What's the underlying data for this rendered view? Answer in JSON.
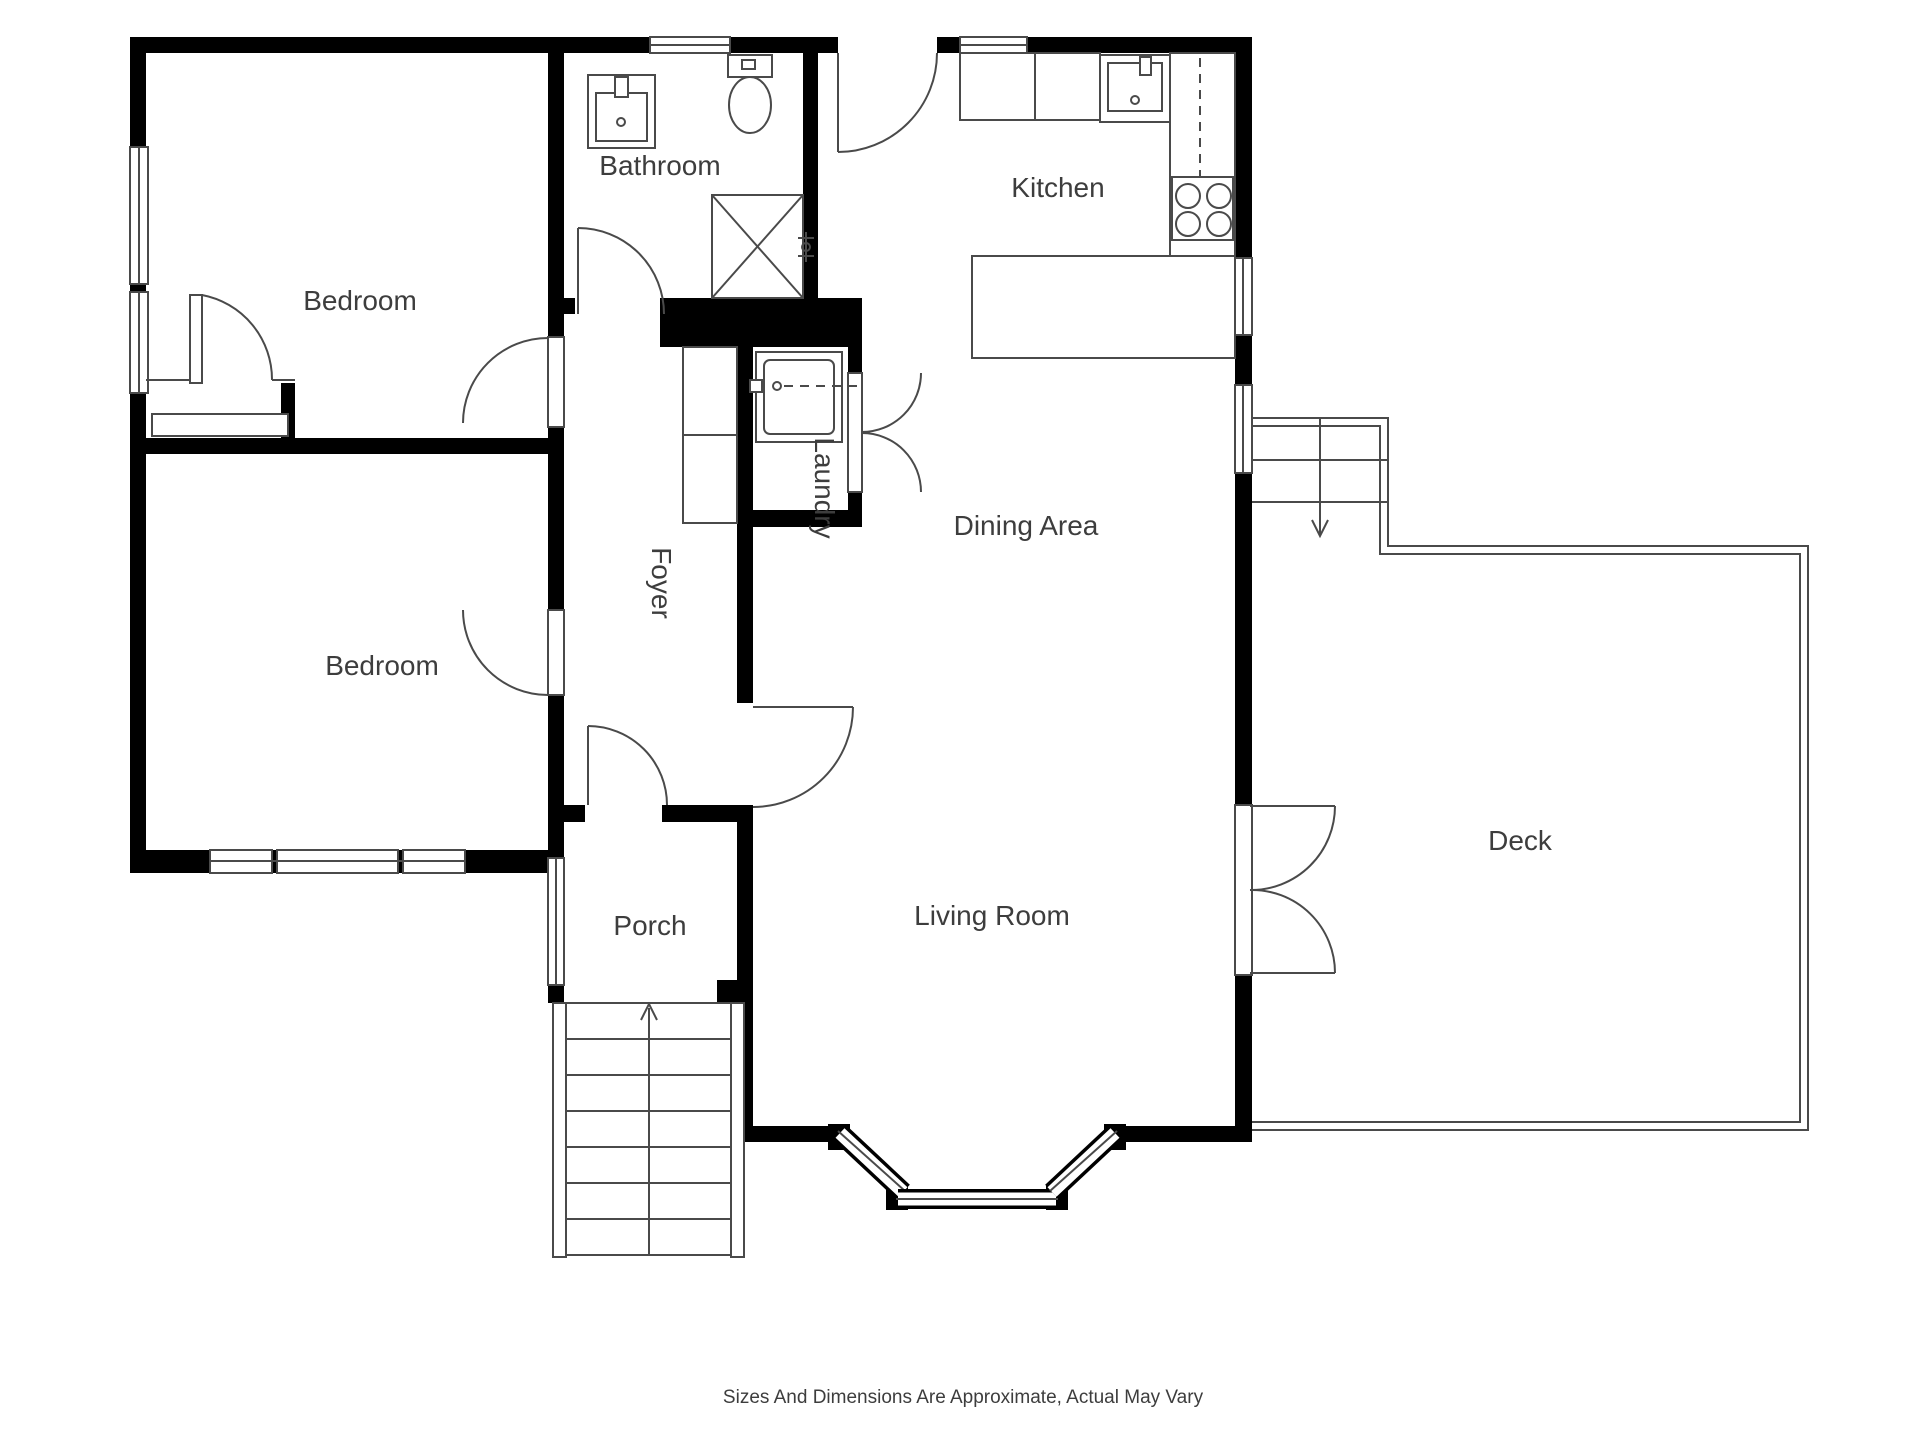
{
  "page": {
    "type": "floor-plan"
  },
  "colors": {
    "wall": "#000000",
    "line": "#4a4a4a",
    "text": "#3d3d3d",
    "background": "#ffffff"
  },
  "rooms": {
    "bedroom_top": {
      "label": "Bedroom"
    },
    "bedroom_bottom": {
      "label": "Bedroom"
    },
    "bathroom": {
      "label": "Bathroom"
    },
    "kitchen": {
      "label": "Kitchen"
    },
    "dining_area": {
      "label": "Dining Area"
    },
    "living_room": {
      "label": "Living Room"
    },
    "foyer": {
      "label": "Foyer"
    },
    "laundry": {
      "label": "Laundry"
    },
    "porch": {
      "label": "Porch"
    },
    "deck": {
      "label": "Deck"
    }
  },
  "icons": [
    "bathroom-sink-icon",
    "toilet-icon",
    "shower-icon",
    "washer-icon",
    "kitchen-sink-icon",
    "stove-icon",
    "kitchen-counter",
    "kitchen-island",
    "entry-stairs-up-arrow",
    "deck-stairs-down-arrow",
    "french-doors",
    "bifold-doors",
    "bay-window",
    "closet"
  ],
  "footer": {
    "disclaimer": "Sizes And Dimensions Are Approximate, Actual May Vary"
  }
}
